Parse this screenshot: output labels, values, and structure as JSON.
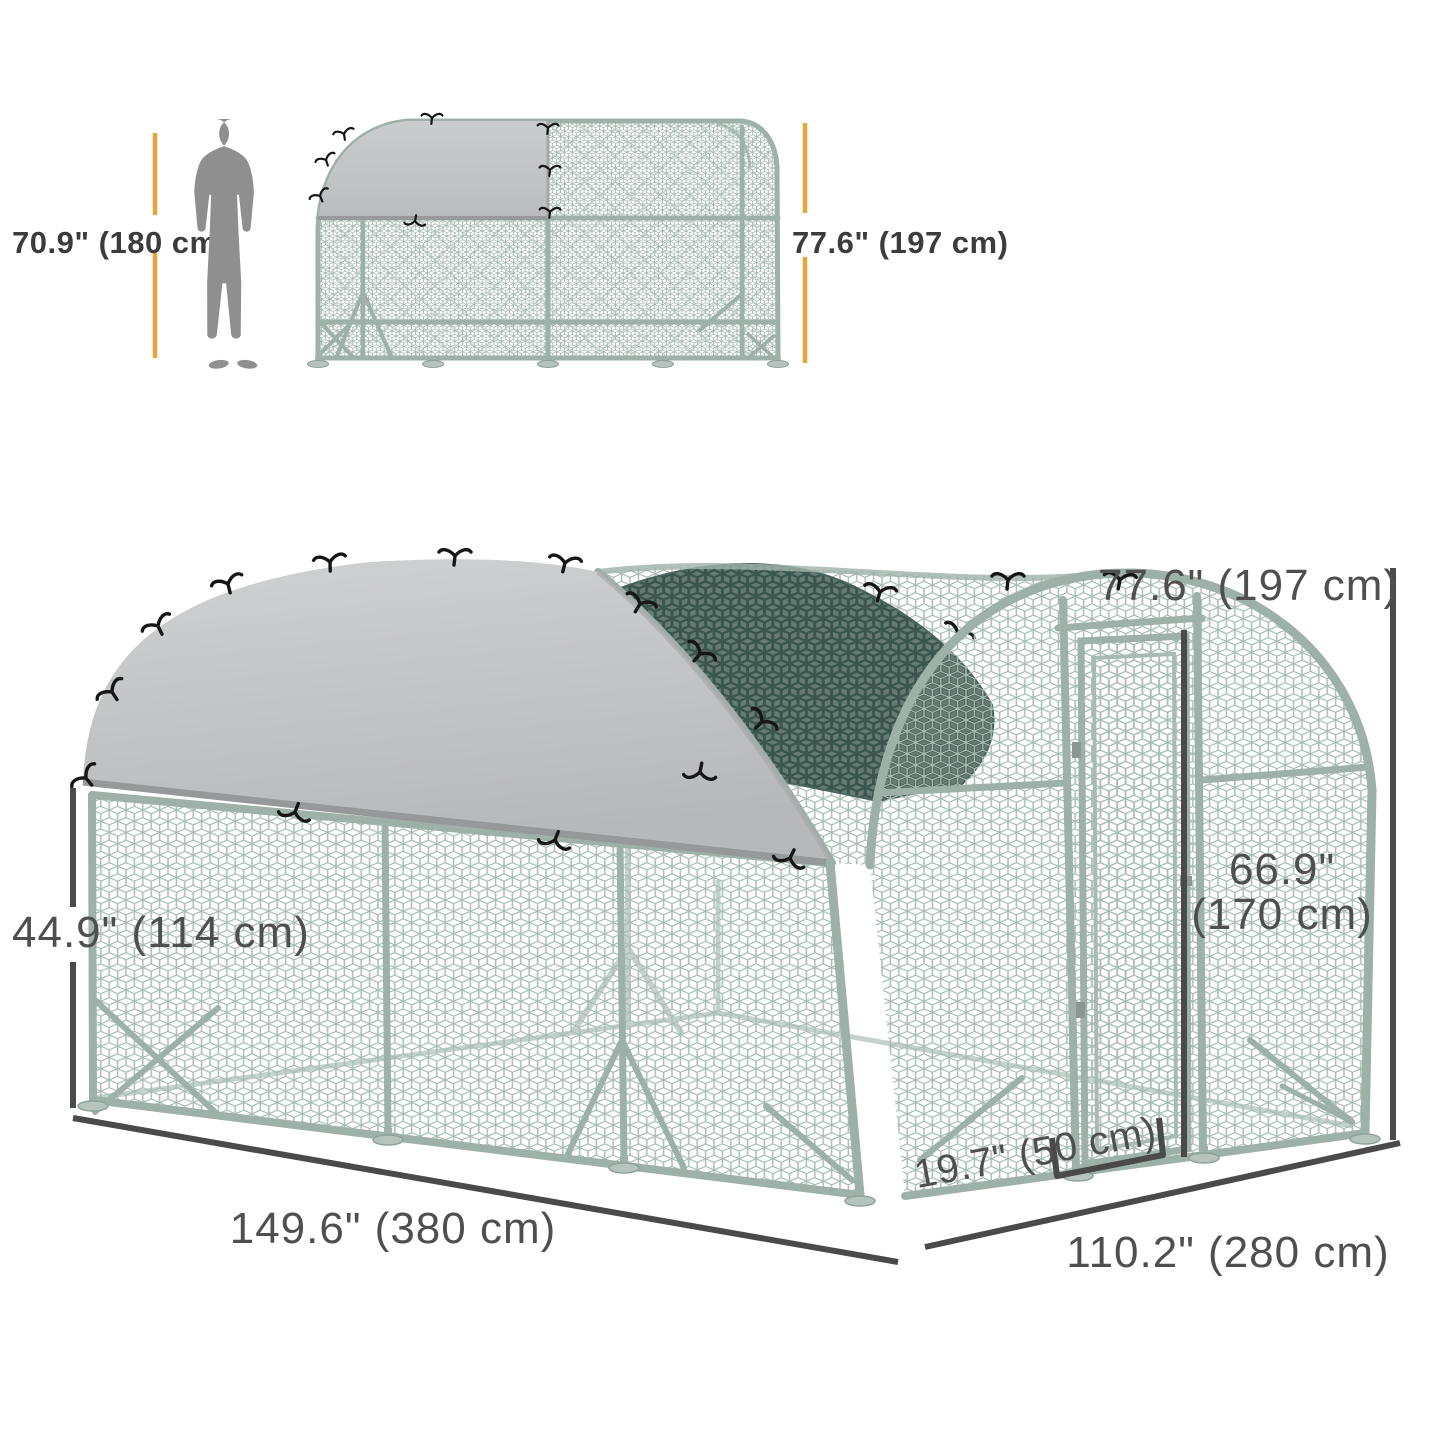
{
  "figure_type": "product-dimension-diagram",
  "product": "walk-in dome chicken run with partial cover",
  "scale_figure": {
    "person_height_label": "70.9\" (180 cm)",
    "coop_height_label": "77.6\" (197 cm)"
  },
  "main_figure": {
    "total_height_label": "77.6\" (197 cm)",
    "door_height_label_line1": "66.9\"",
    "door_height_label_line2": "(170 cm)",
    "wall_height_label": "44.9\" (114 cm)",
    "door_width_label": "19.7\" (50 cm)",
    "length_label": "149.6\" (380 cm)",
    "depth_label": "110.2\" (280 cm)"
  },
  "colors": {
    "accent_yellow": "#E7A53C",
    "dimension_text": "#4f4f4f",
    "dimension_line": "#4a4a4a",
    "tarp_gray": "#c3c4c6",
    "shade_green": "#64776F",
    "mesh_silver": "#a9bdb3",
    "silhouette_gray": "#8f8f8f",
    "background": "#ffffff"
  }
}
